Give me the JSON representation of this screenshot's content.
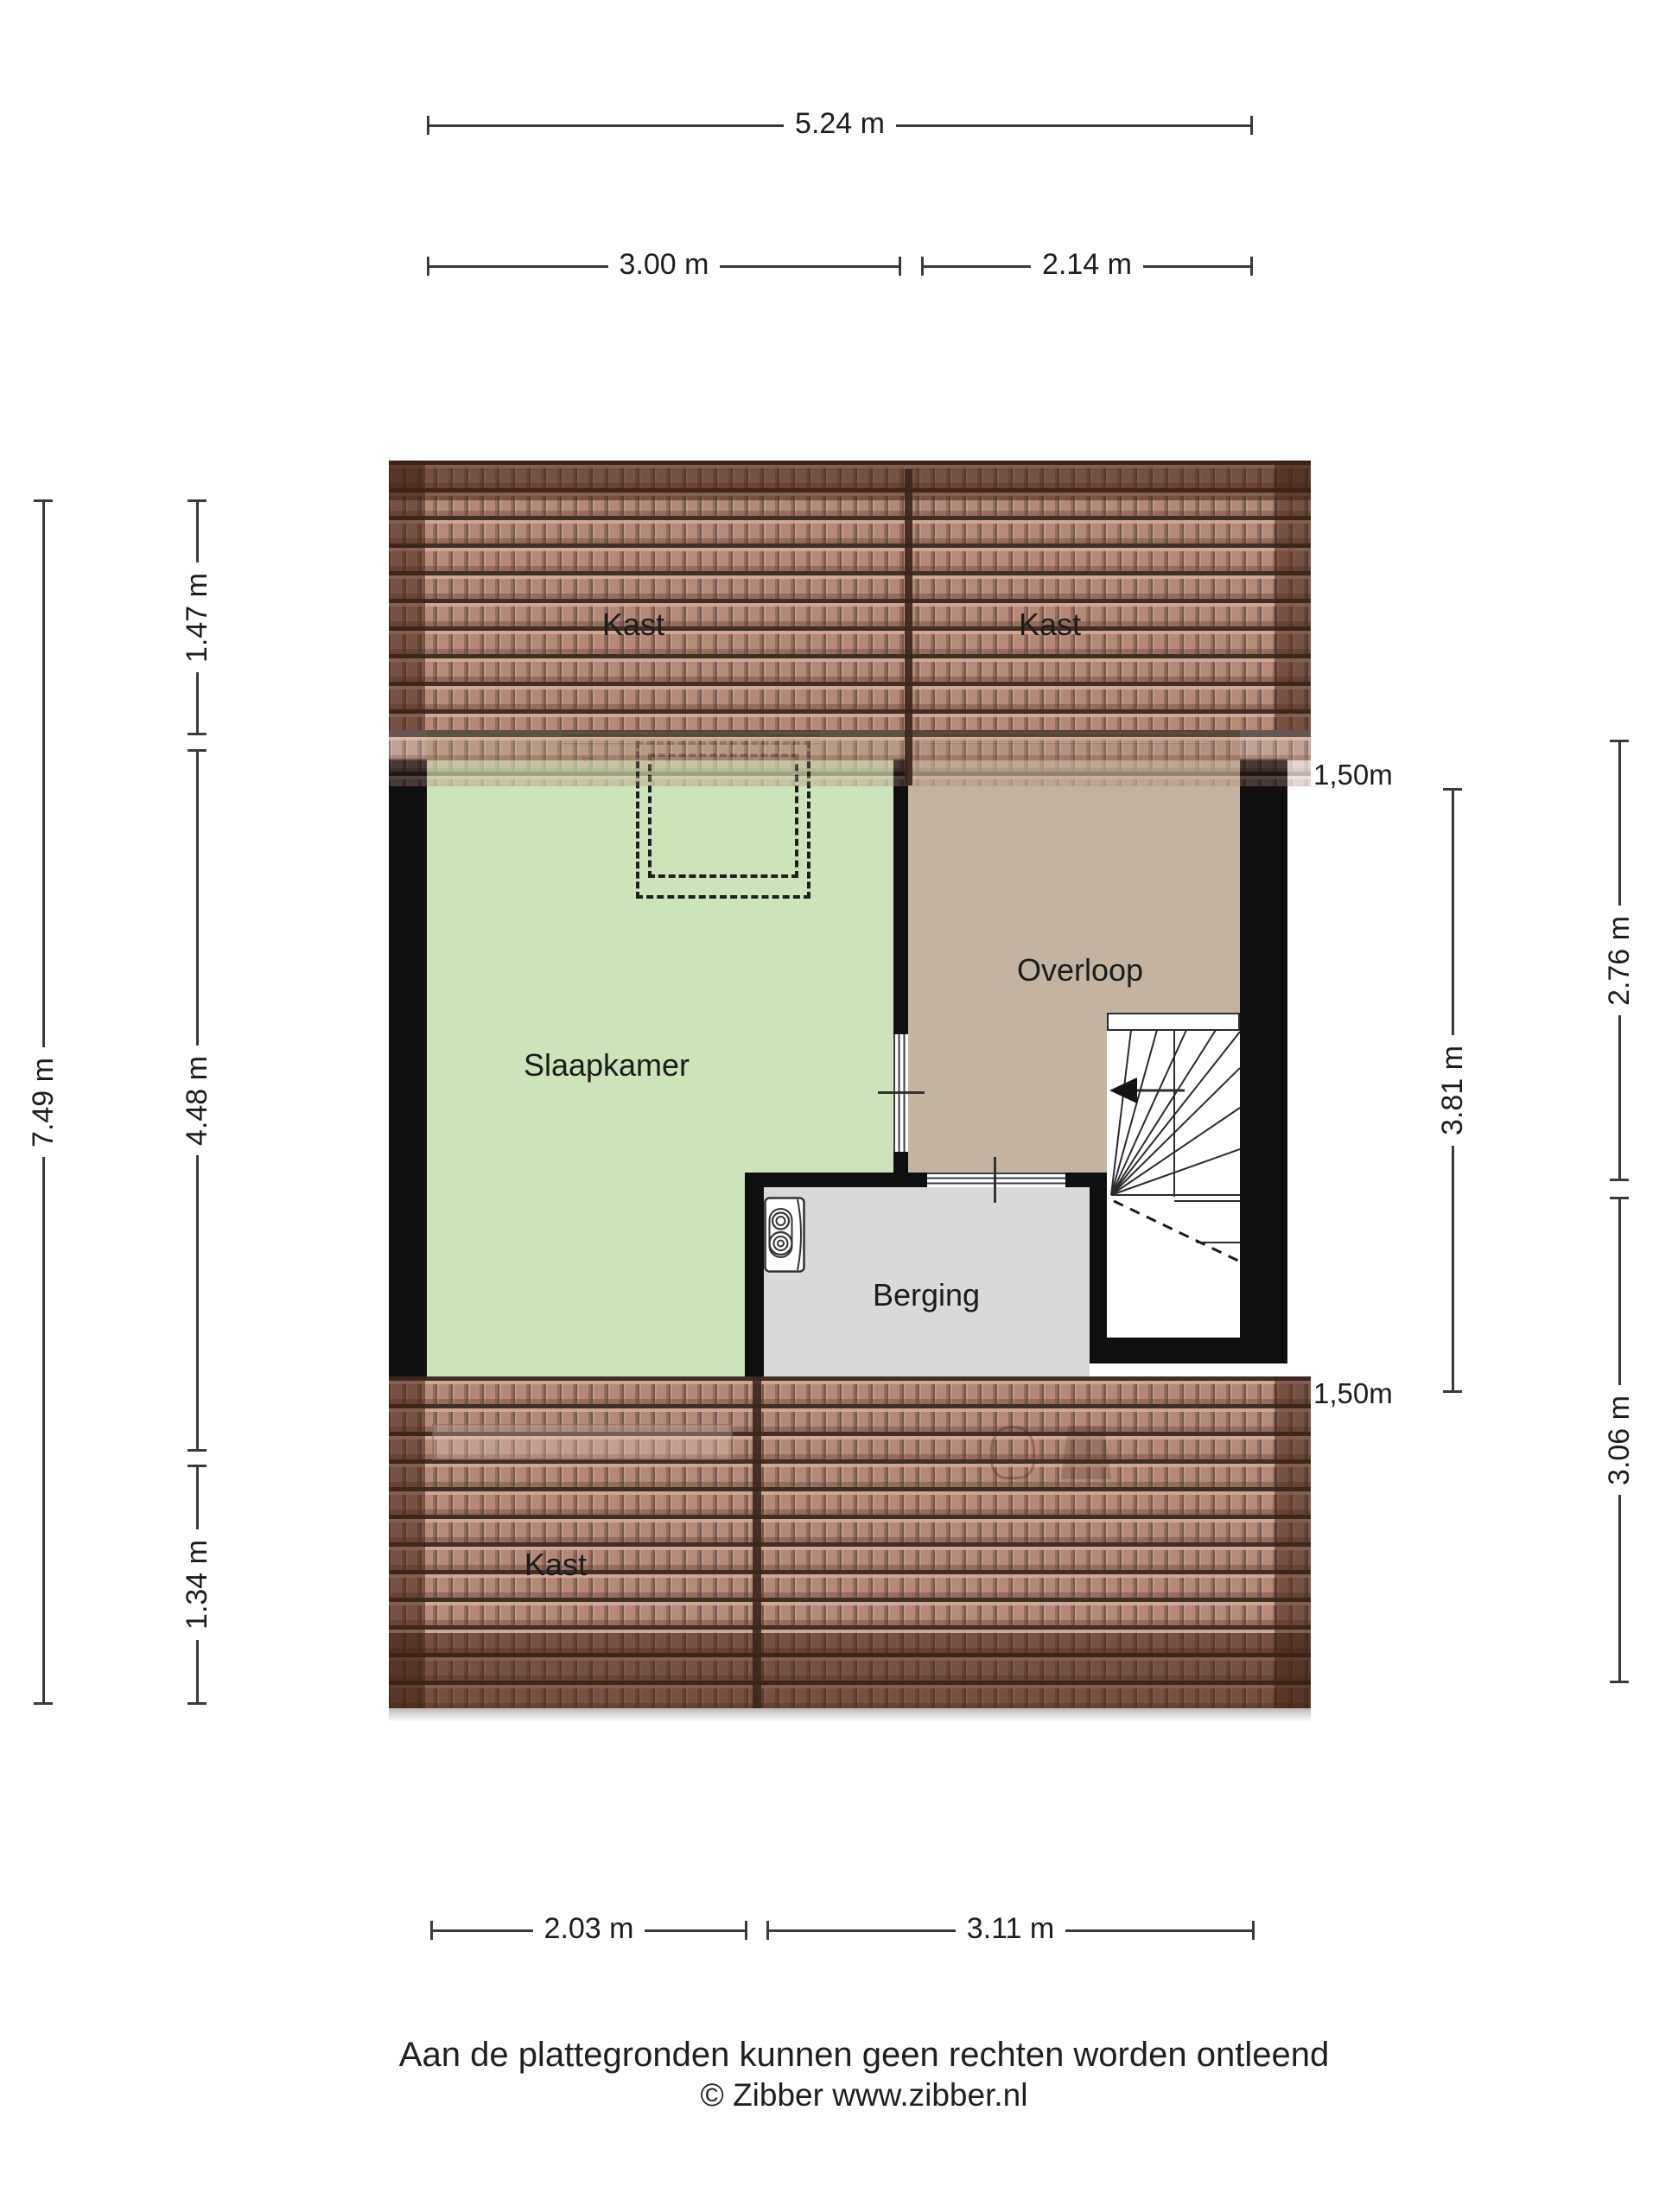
{
  "floorplan": {
    "rooms": {
      "kast_top_left": "Kast",
      "kast_top_right": "Kast",
      "slaapkamer": "Slaapkamer",
      "overloop": "Overloop",
      "berging": "Berging",
      "kast_bottom": "Kast"
    },
    "dimensions": {
      "total_width": "5.24 m",
      "top_width_left": "3.00 m",
      "top_width_right": "2.14 m",
      "total_height": "7.49 m",
      "left_height_top": "1.47 m",
      "left_height_middle": "4.48 m",
      "left_height_bottom": "1.34 m",
      "knee_wall_top": "1,50m",
      "knee_wall_bottom": "1,50m",
      "right_height_upper": "2.76 m",
      "right_height_stairwell": "3.81 m",
      "right_height_lower": "3.06 m",
      "bottom_width_left": "2.03 m",
      "bottom_width_right": "3.11 m"
    },
    "icons": {
      "boiler": "cv-boiler-icon",
      "stairs_arrow": "stair-direction-arrow",
      "vide": "dashed-opening-outline"
    },
    "colors": {
      "room_slaapkamer": "#cde3ba",
      "room_overloop": "#c3b3a2",
      "room_berging": "#d9d9d9",
      "stairwell": "#ffffff",
      "roof_tile": "#b4897a",
      "roof_tile_dark": "#6b4336",
      "wall": "#0f0f0f",
      "dimension_line": "#3a3a3a",
      "text": "#1d1d1d"
    },
    "footer": {
      "disclaimer": "Aan de plattegronden kunnen geen rechten worden ontleend",
      "copyright": "© Zibber www.zibber.nl"
    }
  }
}
